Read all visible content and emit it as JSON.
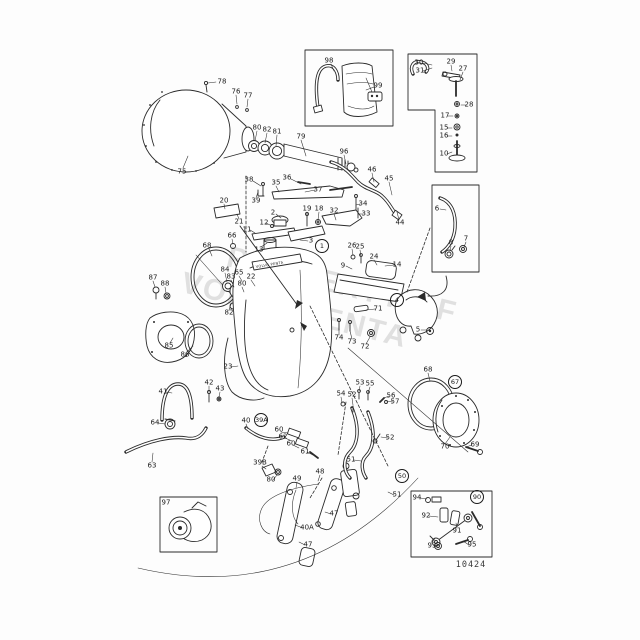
{
  "watermark": {
    "line1": "PROPERTY OF",
    "line2": "VOLVO PENTA"
  },
  "drawing_number": "10424",
  "decal_text": "VOLVO PENTA",
  "labels": [
    {
      "t": "78",
      "x": 222,
      "y": 82
    },
    {
      "t": "76",
      "x": 236,
      "y": 92
    },
    {
      "t": "77",
      "x": 248,
      "y": 96
    },
    {
      "t": "75",
      "x": 182,
      "y": 172
    },
    {
      "t": "80",
      "x": 257,
      "y": 128
    },
    {
      "t": "82",
      "x": 267,
      "y": 130
    },
    {
      "t": "81",
      "x": 277,
      "y": 132
    },
    {
      "t": "79",
      "x": 301,
      "y": 137
    },
    {
      "t": "96",
      "x": 344,
      "y": 152
    },
    {
      "t": "46",
      "x": 372,
      "y": 170
    },
    {
      "t": "45",
      "x": 389,
      "y": 179
    },
    {
      "t": "44",
      "x": 400,
      "y": 223
    },
    {
      "t": "38",
      "x": 249,
      "y": 180
    },
    {
      "t": "35",
      "x": 276,
      "y": 183
    },
    {
      "t": "36",
      "x": 287,
      "y": 178
    },
    {
      "t": "37",
      "x": 318,
      "y": 190
    },
    {
      "t": "39",
      "x": 256,
      "y": 201
    },
    {
      "t": "20",
      "x": 224,
      "y": 201
    },
    {
      "t": "21",
      "x": 239,
      "y": 222
    },
    {
      "t": "2",
      "x": 273,
      "y": 213
    },
    {
      "t": "12",
      "x": 264,
      "y": 223
    },
    {
      "t": "11",
      "x": 247,
      "y": 230
    },
    {
      "t": "19",
      "x": 307,
      "y": 209
    },
    {
      "t": "18",
      "x": 319,
      "y": 209
    },
    {
      "t": "32",
      "x": 334,
      "y": 211
    },
    {
      "t": "34",
      "x": 363,
      "y": 204
    },
    {
      "t": "33",
      "x": 366,
      "y": 214
    },
    {
      "t": "13",
      "x": 259,
      "y": 250
    },
    {
      "t": "3",
      "x": 311,
      "y": 241
    },
    {
      "t": "66",
      "x": 232,
      "y": 236
    },
    {
      "t": "68",
      "x": 207,
      "y": 246
    },
    {
      "t": "1",
      "x": 322,
      "y": 246,
      "c": 1
    },
    {
      "t": "26",
      "x": 352,
      "y": 246
    },
    {
      "t": "25",
      "x": 360,
      "y": 247
    },
    {
      "t": "24",
      "x": 374,
      "y": 257
    },
    {
      "t": "9",
      "x": 343,
      "y": 266
    },
    {
      "t": "14",
      "x": 397,
      "y": 265
    },
    {
      "t": "65",
      "x": 239,
      "y": 273
    },
    {
      "t": "22",
      "x": 251,
      "y": 277
    },
    {
      "t": "84",
      "x": 225,
      "y": 270
    },
    {
      "t": "83",
      "x": 231,
      "y": 277
    },
    {
      "t": "80",
      "x": 242,
      "y": 284
    },
    {
      "t": "82",
      "x": 229,
      "y": 313
    },
    {
      "t": "87",
      "x": 153,
      "y": 278
    },
    {
      "t": "88",
      "x": 165,
      "y": 284
    },
    {
      "t": "85",
      "x": 169,
      "y": 346
    },
    {
      "t": "86",
      "x": 185,
      "y": 355
    },
    {
      "t": "71",
      "x": 378,
      "y": 309
    },
    {
      "t": "4",
      "x": 397,
      "y": 300,
      "c": 1
    },
    {
      "t": "5",
      "x": 418,
      "y": 330
    },
    {
      "t": "74",
      "x": 339,
      "y": 338
    },
    {
      "t": "73",
      "x": 352,
      "y": 342
    },
    {
      "t": "72",
      "x": 365,
      "y": 347
    },
    {
      "t": "23",
      "x": 228,
      "y": 367
    },
    {
      "t": "42",
      "x": 209,
      "y": 383
    },
    {
      "t": "43",
      "x": 220,
      "y": 389
    },
    {
      "t": "41",
      "x": 163,
      "y": 392
    },
    {
      "t": "64",
      "x": 155,
      "y": 423
    },
    {
      "t": "63",
      "x": 152,
      "y": 466
    },
    {
      "t": "40",
      "x": 246,
      "y": 421
    },
    {
      "t": "39A",
      "x": 261,
      "y": 420,
      "c": 1
    },
    {
      "t": "60",
      "x": 279,
      "y": 430
    },
    {
      "t": "62",
      "x": 283,
      "y": 437
    },
    {
      "t": "60",
      "x": 291,
      "y": 444
    },
    {
      "t": "61",
      "x": 305,
      "y": 452
    },
    {
      "t": "39B",
      "x": 260,
      "y": 463
    },
    {
      "t": "80",
      "x": 271,
      "y": 480
    },
    {
      "t": "49",
      "x": 297,
      "y": 479
    },
    {
      "t": "48",
      "x": 320,
      "y": 472
    },
    {
      "t": "53",
      "x": 360,
      "y": 383
    },
    {
      "t": "55",
      "x": 370,
      "y": 384
    },
    {
      "t": "54",
      "x": 341,
      "y": 394
    },
    {
      "t": "52",
      "x": 352,
      "y": 395
    },
    {
      "t": "56",
      "x": 391,
      "y": 396
    },
    {
      "t": "57",
      "x": 395,
      "y": 402
    },
    {
      "t": "52",
      "x": 390,
      "y": 438
    },
    {
      "t": "51",
      "x": 351,
      "y": 460
    },
    {
      "t": "50",
      "x": 402,
      "y": 476,
      "c": 1
    },
    {
      "t": "51",
      "x": 397,
      "y": 495
    },
    {
      "t": "40A",
      "x": 307,
      "y": 528
    },
    {
      "t": "47",
      "x": 334,
      "y": 514
    },
    {
      "t": "47",
      "x": 308,
      "y": 545
    },
    {
      "t": "68",
      "x": 428,
      "y": 370
    },
    {
      "t": "67",
      "x": 455,
      "y": 382,
      "c": 1
    },
    {
      "t": "70",
      "x": 445,
      "y": 447
    },
    {
      "t": "69",
      "x": 475,
      "y": 445
    },
    {
      "t": "30",
      "x": 419,
      "y": 63
    },
    {
      "t": "31",
      "x": 420,
      "y": 71
    },
    {
      "t": "29",
      "x": 451,
      "y": 62
    },
    {
      "t": "27",
      "x": 463,
      "y": 69
    },
    {
      "t": "28",
      "x": 469,
      "y": 105
    },
    {
      "t": "17",
      "x": 445,
      "y": 116
    },
    {
      "t": "15",
      "x": 444,
      "y": 128
    },
    {
      "t": "16",
      "x": 444,
      "y": 136
    },
    {
      "t": "10",
      "x": 444,
      "y": 154
    },
    {
      "t": "6",
      "x": 437,
      "y": 209
    },
    {
      "t": "8",
      "x": 451,
      "y": 243
    },
    {
      "t": "7",
      "x": 466,
      "y": 239
    },
    {
      "t": "98",
      "x": 329,
      "y": 61
    },
    {
      "t": "99",
      "x": 378,
      "y": 86
    },
    {
      "t": "97",
      "x": 166,
      "y": 503
    },
    {
      "t": "90",
      "x": 477,
      "y": 497,
      "c": 1
    },
    {
      "t": "94",
      "x": 417,
      "y": 498
    },
    {
      "t": "92",
      "x": 426,
      "y": 516
    },
    {
      "t": "93",
      "x": 432,
      "y": 546
    },
    {
      "t": "91",
      "x": 457,
      "y": 531
    },
    {
      "t": "95",
      "x": 472,
      "y": 545
    }
  ]
}
